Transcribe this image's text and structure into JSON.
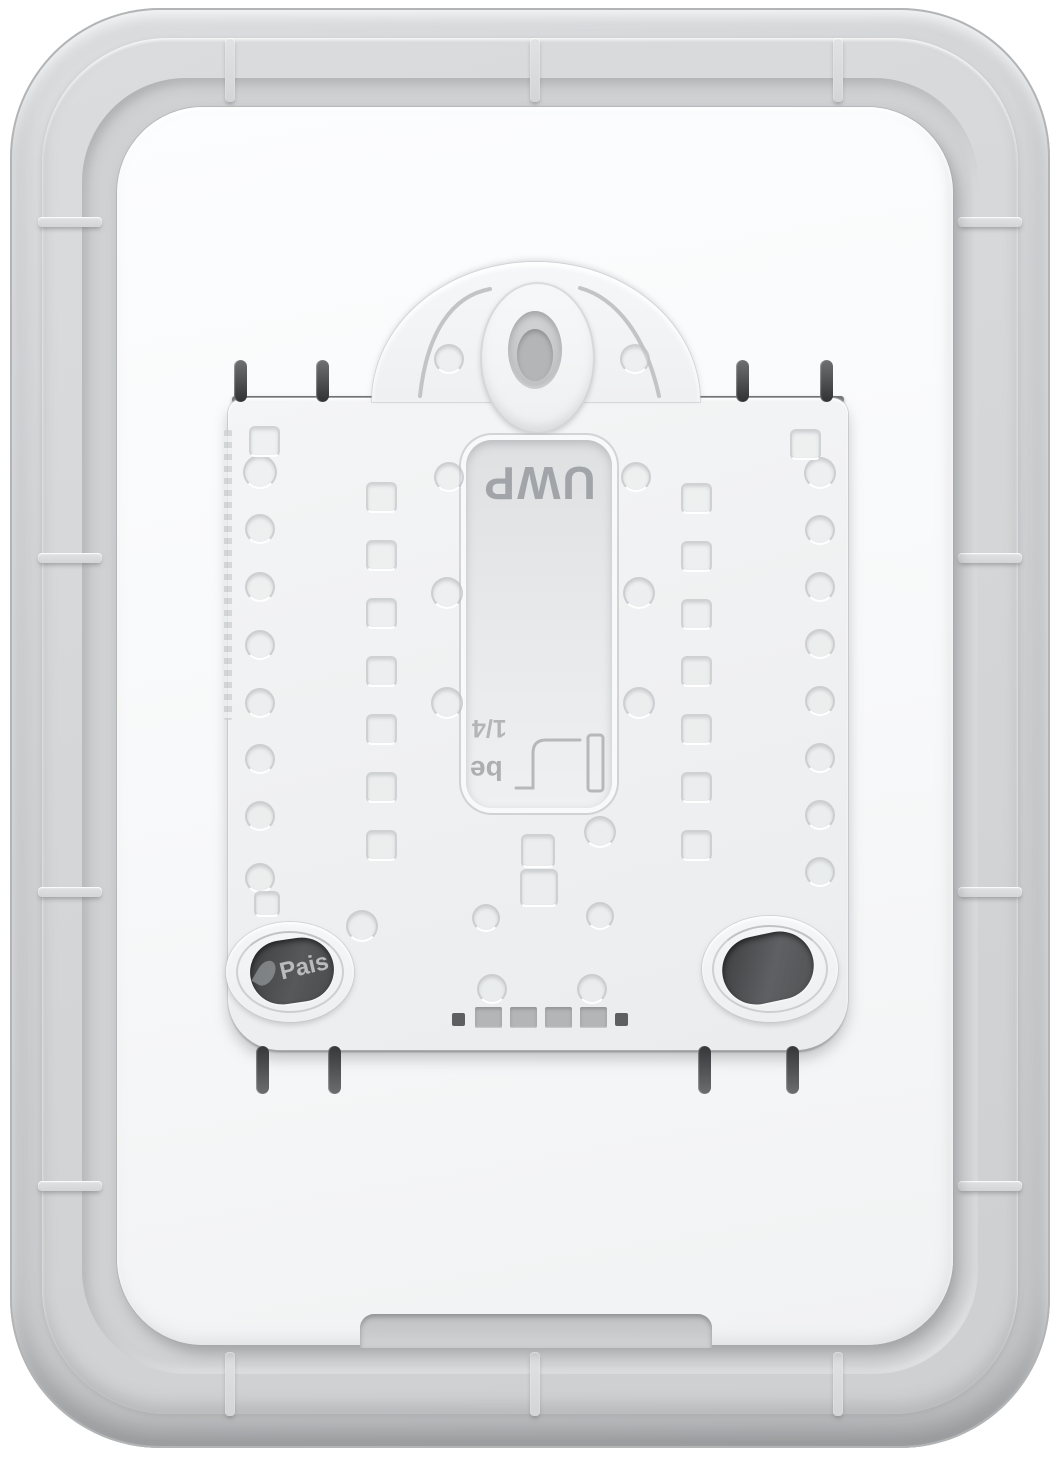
{
  "image": {
    "description": "Rear view of a white thermostat back plate with UWP mounting system, clipped into a light-gray wall cover plate",
    "type": "product-photo"
  },
  "markings": {
    "window_label": "UWP",
    "strip_gauge_fraction": "1/4",
    "strip_gauge_text": "be",
    "hole_text": "Pais"
  },
  "colors": {
    "background": "#ffffff",
    "cover_plate": "#d2d4d6",
    "cover_plate_recess": "#cfd1d3",
    "back_plate": "#f8f9fa",
    "bracket": "#f0f1f2",
    "window_recess": "#e2e4e6",
    "marking_text": "#979b9f",
    "slot_dark": "#47494b",
    "vent_gray": "#b3b5b7",
    "prong_dark": "#3e4042"
  }
}
